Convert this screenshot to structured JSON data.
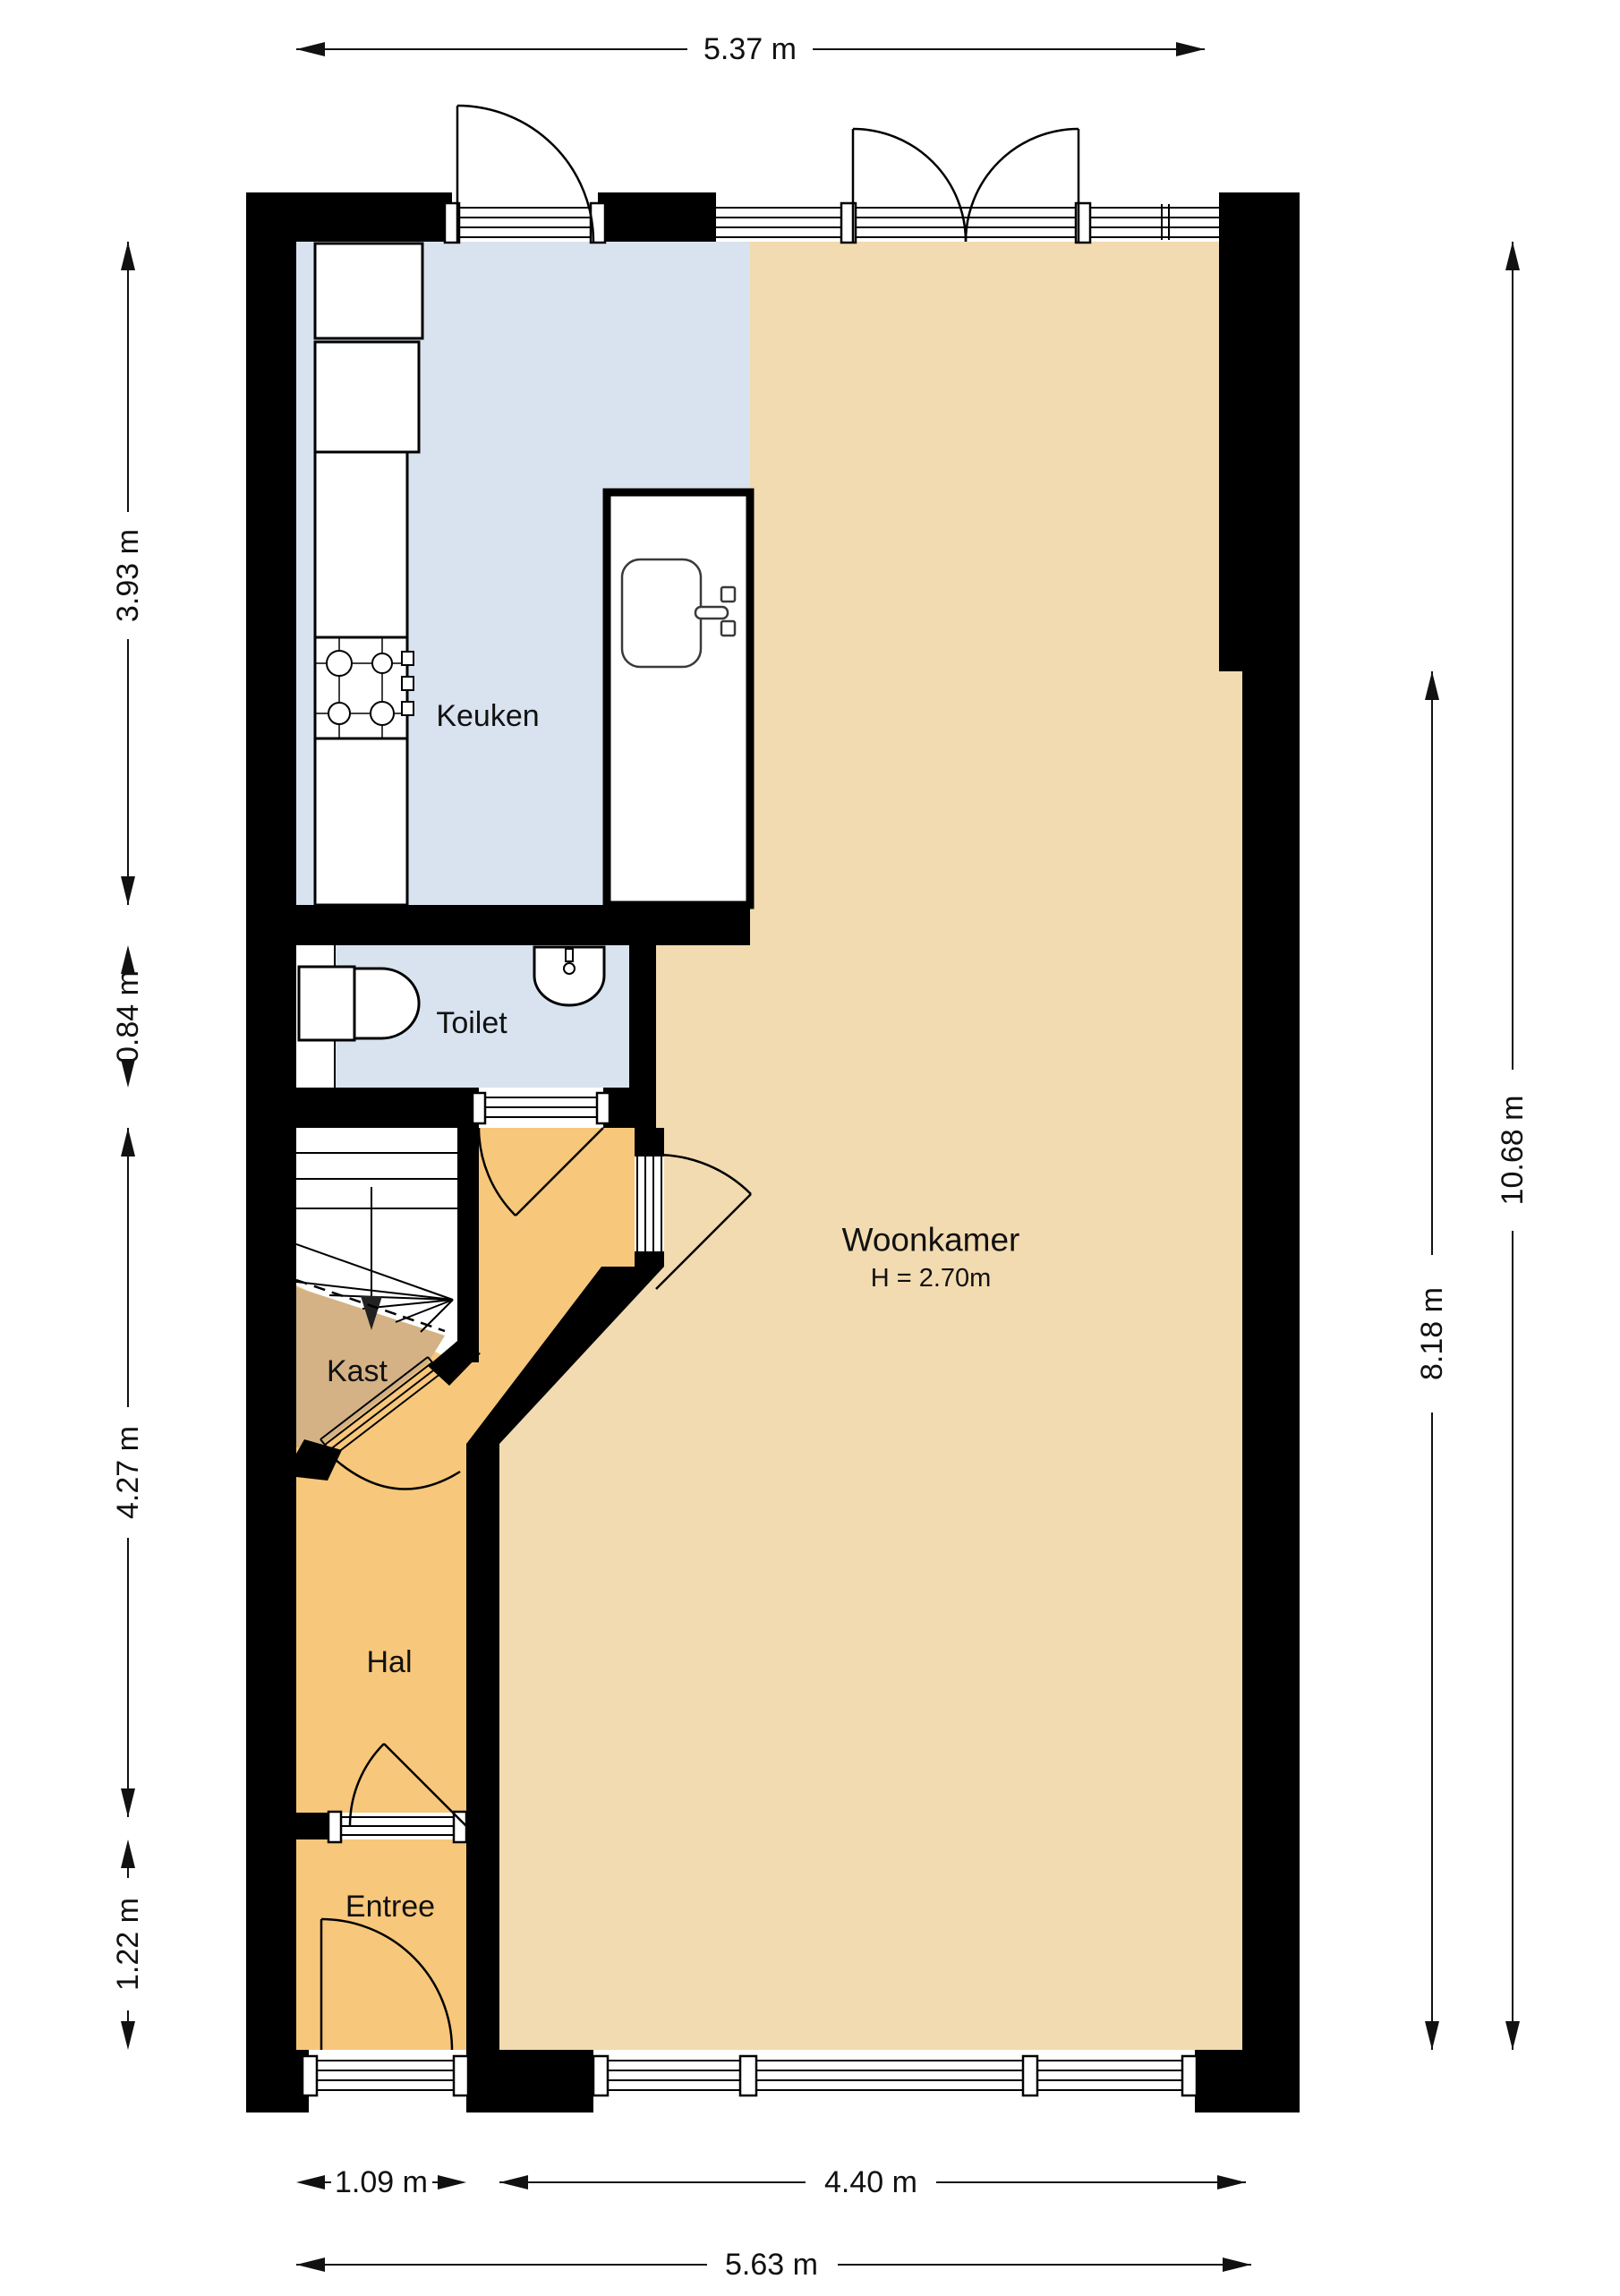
{
  "rooms": {
    "keuken": {
      "label": "Keuken"
    },
    "toilet": {
      "label": "Toilet"
    },
    "kast": {
      "label": "Kast"
    },
    "hal": {
      "label": "Hal"
    },
    "entree": {
      "label": "Entree"
    },
    "woonkamer": {
      "label": "Woonkamer",
      "height_note": "H = 2.70m"
    }
  },
  "dimensions": {
    "top": {
      "label": "5.37 m"
    },
    "left": [
      {
        "label": "3.93 m"
      },
      {
        "label": "0.84 m"
      },
      {
        "label": "4.27 m"
      },
      {
        "label": "1.22 m"
      }
    ],
    "right": [
      {
        "label": "10.68 m"
      },
      {
        "label": "8.18 m"
      }
    ],
    "bottom": [
      {
        "label": "1.09 m"
      },
      {
        "label": "4.40 m"
      },
      {
        "label": "5.63 m"
      }
    ]
  },
  "colors": {
    "wall": "#000000",
    "kitchen_floor": "#D8E3EF",
    "toilet_floor": "#D8E3EF",
    "living_floor": "#F2DBB0",
    "hall_floor": "#F7C77B",
    "entree_floor": "#F7C77B",
    "closet_floor": "#D4B285",
    "line": "#111111"
  }
}
